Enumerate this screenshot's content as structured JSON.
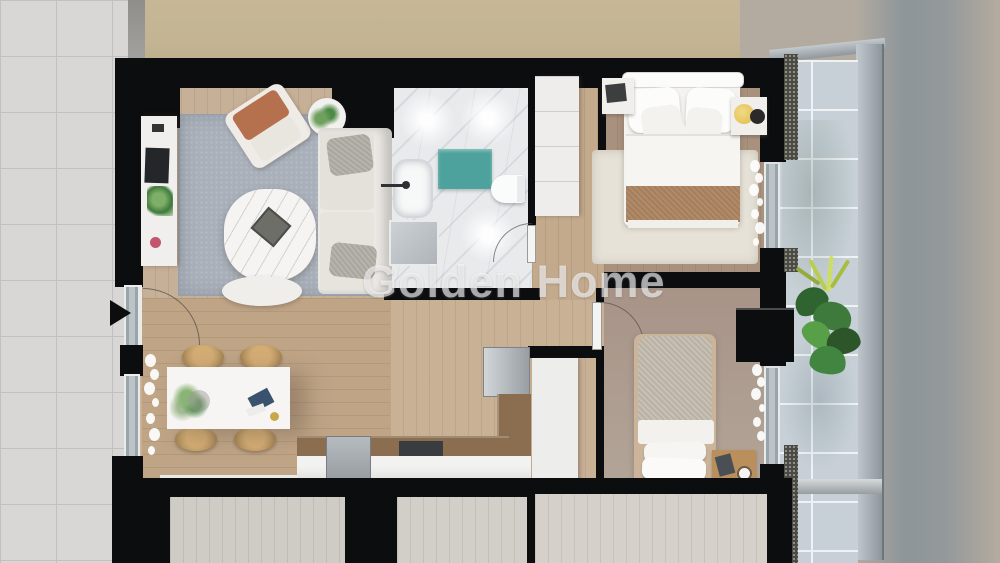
{
  "watermark": {
    "text": "Golden Home"
  },
  "scene": {
    "type": "architectural-floor-plan-render",
    "view": "top-down-3d",
    "rooms": [
      "living-room",
      "bathroom",
      "corridor",
      "master-bedroom",
      "second-bedroom",
      "dining-area",
      "kitchen",
      "balcony",
      "entrance"
    ]
  },
  "entrance": {
    "marker": "right-pointing-arrow"
  },
  "colors": {
    "wall": "#0c0d0f",
    "sidewalk_tile": "#d8d7d5",
    "tile_grout": "#c2c1bf",
    "stucco": "#c3b493",
    "concrete": "#b3aba0",
    "concrete_shadow": "#6e8296",
    "balcony_tile": "#c6d0d6",
    "living_floor": "#c6b097",
    "dining_floor": "#bfa486",
    "hall_floor": "#c9b196",
    "corridor_floor": "#c3aa8d",
    "master_floor": "#a8917d",
    "bedroom2_floor": "#a89387",
    "marble": "#e8eaec",
    "rug": "#a9b0ba",
    "cream_rug": "#e7e2d8",
    "counter_brown": "#8a6e4f",
    "counter_white": "#e7e7e5",
    "teal_mat": "#4ea29d",
    "terracotta": "#b5714e",
    "tan_throw": "#b18a67",
    "rattan": "#bd9a66",
    "lamp_yellow": "#e5c45c",
    "plant_green": "#3e7a3c",
    "watermark_white": "#ffffff"
  }
}
